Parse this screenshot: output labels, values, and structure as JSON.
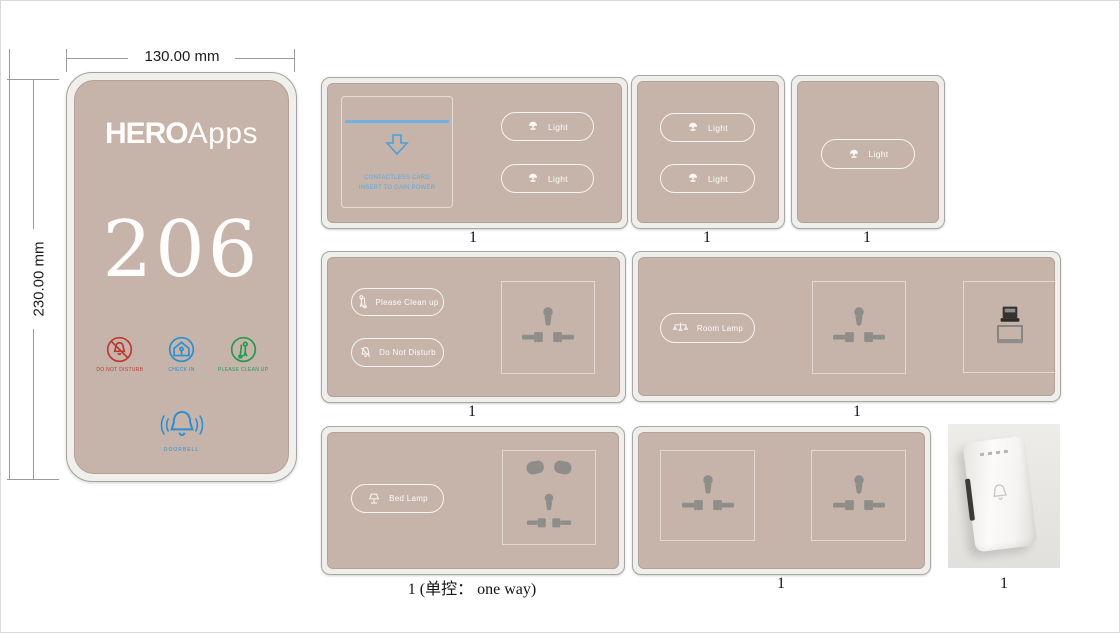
{
  "dimensions": {
    "width_label": "130.00 mm",
    "height_label": "230.00 mm"
  },
  "door_panel": {
    "brand_bold": "HERO",
    "brand_light": "Apps",
    "room_number": "206",
    "status_icons": [
      {
        "name": "do-not-disturb",
        "label": "DO NOT DISTURB",
        "color": "#c0392e"
      },
      {
        "name": "check-in",
        "label": "CHECK IN",
        "color": "#2b8fd0"
      },
      {
        "name": "please-clean-up",
        "label": "PLEASE CLEAN UP",
        "color": "#27994f"
      }
    ],
    "doorbell_label": "DOORBELL"
  },
  "panels": {
    "key_card": {
      "caption": "1",
      "card_slot": {
        "line1": "CONTACTLESS CARD",
        "line2": "INSERT TO GAIN POWER"
      },
      "buttons": [
        {
          "label": "Light"
        },
        {
          "label": "Light"
        }
      ]
    },
    "two_gang": {
      "caption": "1",
      "buttons": [
        {
          "label": "Light"
        },
        {
          "label": "Light"
        }
      ]
    },
    "one_gang": {
      "caption": "1",
      "buttons": [
        {
          "label": "Light"
        }
      ]
    },
    "service": {
      "caption": "1",
      "buttons": [
        {
          "label": "Please Clean up"
        },
        {
          "label": "Do Not Disturb"
        }
      ]
    },
    "room_lamp": {
      "caption": "1",
      "buttons": [
        {
          "label": "Room Lamp"
        }
      ]
    },
    "bed_lamp": {
      "caption": "1 (单控： one way)",
      "buttons": [
        {
          "label": "Bed Lamp"
        }
      ]
    },
    "double_socket": {
      "caption": "1"
    },
    "doorbell_device": {
      "caption": "1"
    }
  },
  "colors": {
    "panel_surface": "#c6b4ab",
    "accent_blue": "#4aa0d8",
    "status_red": "#c0392e",
    "status_green": "#27994f",
    "glyph_gray": "#8f8d89"
  }
}
